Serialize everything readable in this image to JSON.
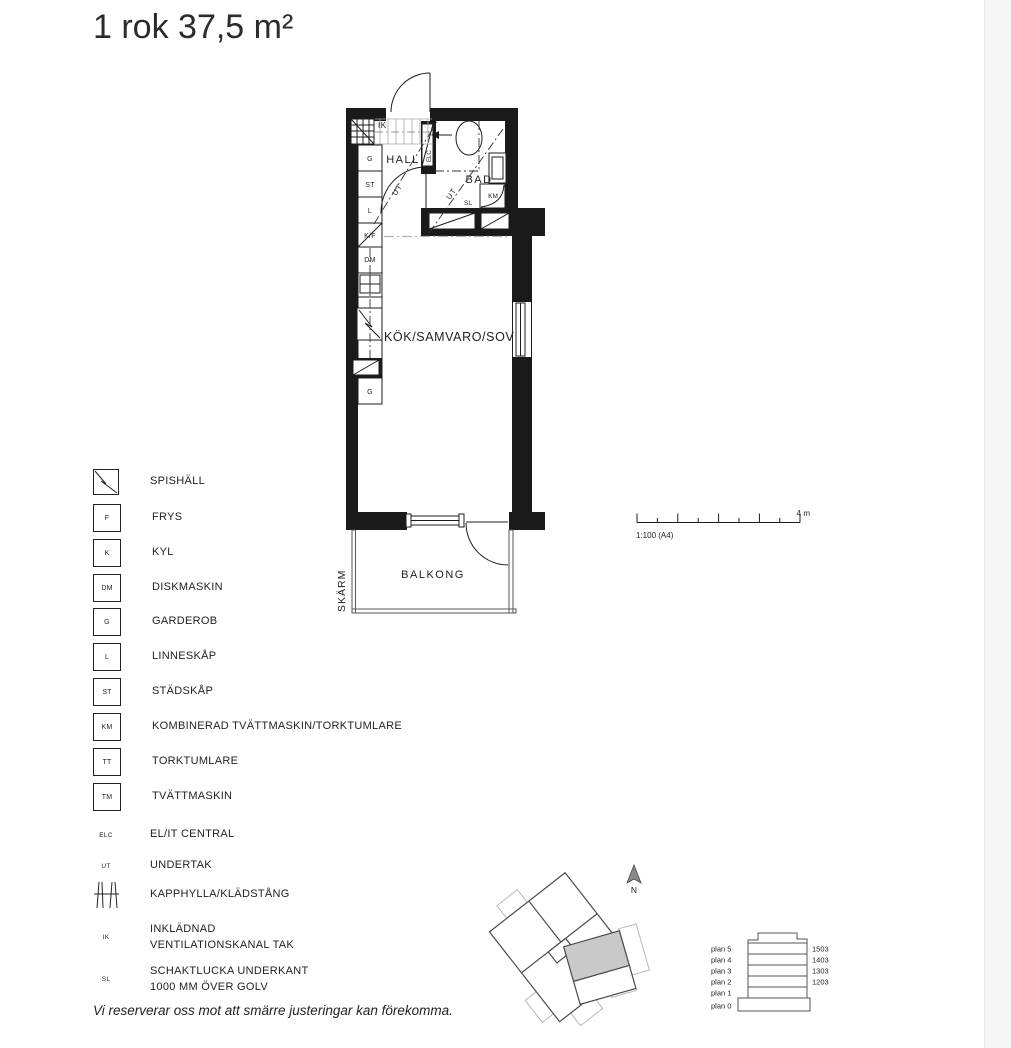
{
  "page": {
    "title": "1 rok 37,5 m²",
    "disclaimer": "Vi reserverar oss mot att smärre justeringar kan förekomma."
  },
  "plan": {
    "labels": {
      "hall": "HALL",
      "bad": "BAD",
      "kok": "KÖK/SAMVARO/SOV",
      "balkong": "BALKONG",
      "skarm": "SKÄRM",
      "ik": "IK",
      "elc": "ELC",
      "ut_hall": "UT",
      "ut_bad": "UT",
      "g1": "G",
      "st": "ST",
      "l": "L",
      "kf": "K/F",
      "dm": "DM",
      "g2": "G",
      "km": "KM",
      "sl": "SL"
    }
  },
  "scale_bar": {
    "length_label": "4 m",
    "ratio_label": "1:100 (A4)"
  },
  "legend": {
    "items": [
      {
        "symbol": "spishall-icon",
        "code": "",
        "label": "SPISHÄLL"
      },
      {
        "symbol": "box",
        "code": "F",
        "label": "FRYS"
      },
      {
        "symbol": "box",
        "code": "K",
        "label": "KYL"
      },
      {
        "symbol": "box",
        "code": "DM",
        "label": "DISKMASKIN"
      },
      {
        "symbol": "box",
        "code": "G",
        "label": "GARDEROB"
      },
      {
        "symbol": "box",
        "code": "L",
        "label": "LINNESKÅP"
      },
      {
        "symbol": "box",
        "code": "ST",
        "label": "STÄDSKÅP"
      },
      {
        "symbol": "box",
        "code": "KM",
        "label": "KOMBINERAD TVÄTTMASKIN/TORKTUMLARE"
      },
      {
        "symbol": "box",
        "code": "TT",
        "label": "TORKTUMLARE"
      },
      {
        "symbol": "box",
        "code": "TM",
        "label": "TVÄTTMASKIN"
      },
      {
        "symbol": "text",
        "code": "ELC",
        "label": "EL/IT CENTRAL"
      },
      {
        "symbol": "text",
        "code": "UT",
        "label": "UNDERTAK"
      },
      {
        "symbol": "kapphylla-icon",
        "code": "",
        "label": "KAPPHYLLA/KLÄDSTÅNG"
      },
      {
        "symbol": "text",
        "code": "IK",
        "label": "INKLÄDNAD\nVENTILATIONSKANAL TAK"
      },
      {
        "symbol": "text",
        "code": "SL",
        "label": "SCHAKTLUCKA UNDERKANT\n1000 MM ÖVER GOLV"
      }
    ]
  },
  "site_plan": {
    "north_label": "N"
  },
  "floor_stack": {
    "rows": [
      {
        "label": "plan 5",
        "number": "1503",
        "highlighted": true
      },
      {
        "label": "plan 4",
        "number": "1403",
        "highlighted": true
      },
      {
        "label": "plan 3",
        "number": "1303",
        "highlighted": true
      },
      {
        "label": "plan 2",
        "number": "1203",
        "highlighted": true
      },
      {
        "label": "plan 1",
        "highlighted": false
      },
      {
        "label": "plan 0",
        "highlighted": false
      }
    ],
    "highlight_color": "#cecece"
  },
  "colors": {
    "wall": "#1a1a1a",
    "unit_highlight": "#c9c9c9"
  }
}
